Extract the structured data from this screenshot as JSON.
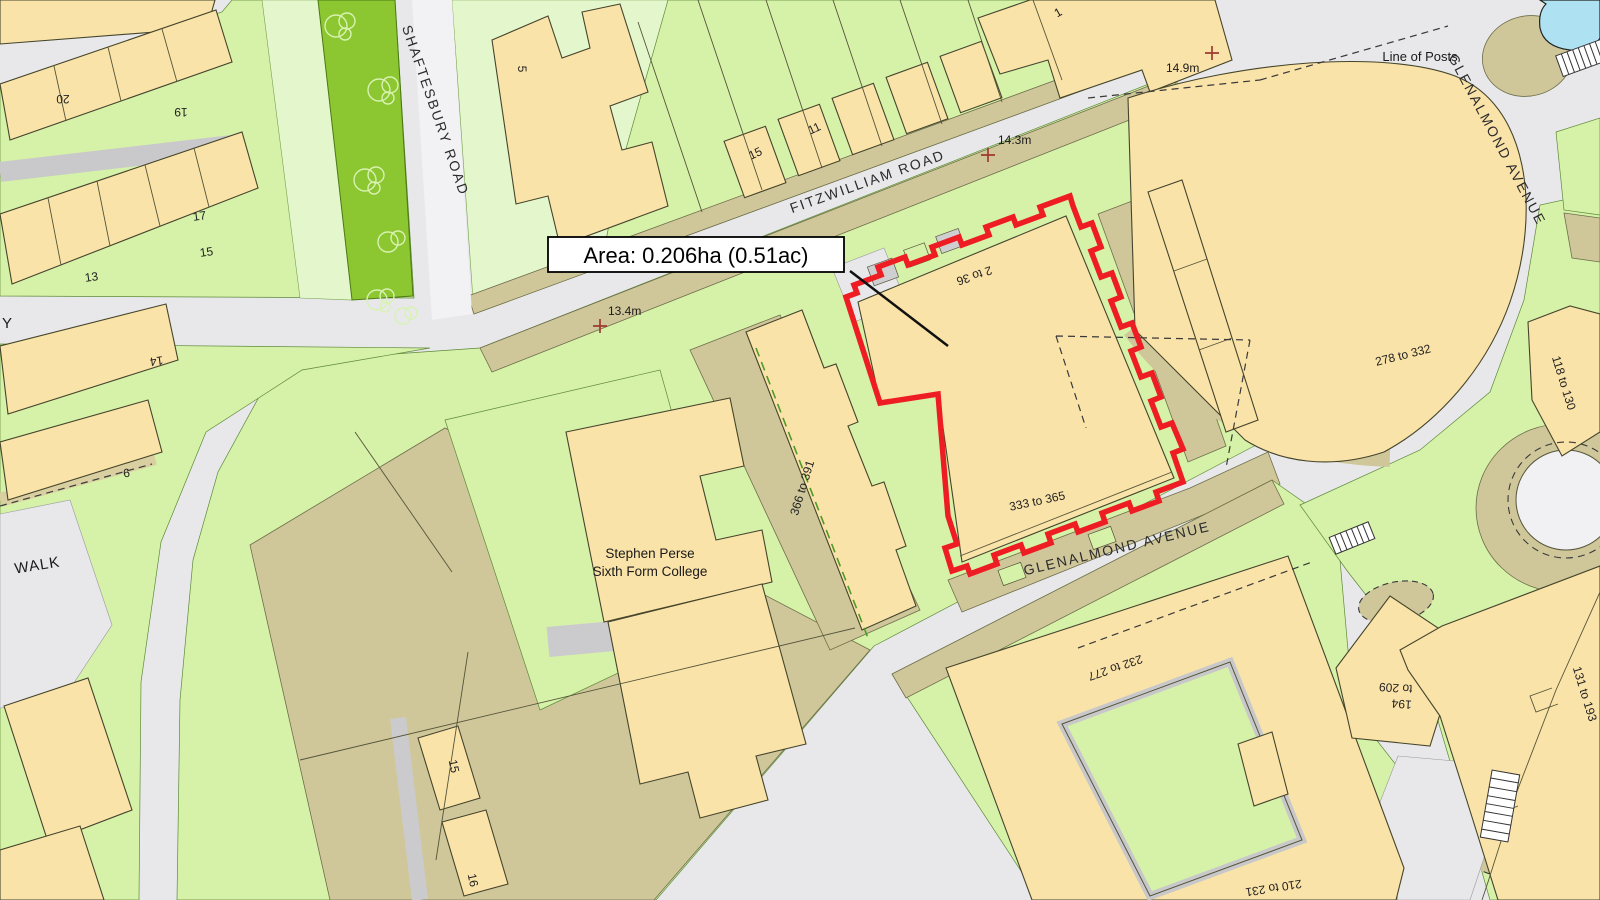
{
  "area_annotation": {
    "text": "Area: 0.206ha (0.51ac)"
  },
  "streets": {
    "shaftesbury": "SHAFTESBURY ROAD",
    "fitzwilliam": "FITZWILLIAM ROAD",
    "glenalmond_upper": "GLENALMOND AVENUE",
    "glenalmond_lower": "GLENALMOND AVENUE",
    "partial_y": "Y",
    "partial_walk": "WALK"
  },
  "annotations": {
    "line_of_posts": "Line of Posts"
  },
  "spot_heights": {
    "h1": "13.4m",
    "h2": "14.3m",
    "h3": "14.9m"
  },
  "places": {
    "college_line1": "Stephen Perse",
    "college_line2": "Sixth Form College"
  },
  "ranges": {
    "r2_36": "2 to 36",
    "r333_365": "333 to 365",
    "r366_391": "366 to 391",
    "r278_332": "278 to 332",
    "r118_130": "118 to 130",
    "r131_193": "131 to 193",
    "r232_277": "232 to 277",
    "r210_231": "210 to 231",
    "r194_line1": "194",
    "r194_line2": "to 209"
  },
  "house_numbers": {
    "n20": "20",
    "n19": "19",
    "n17": "17",
    "n15a": "15",
    "n13": "13",
    "n14": "14",
    "n6": "6",
    "n5": "5",
    "n15b": "15",
    "n11": "11",
    "n1": "1",
    "n15c": "15",
    "n16": "16"
  },
  "colors": {
    "building": "#FAE3A8",
    "garden_green": "#D6F1A8",
    "pale_green": "#E4F7CC",
    "verge_green": "#8CC630",
    "khaki": "#CFC79A",
    "road_grey": "#E8E8EA",
    "path_tan": "#D9CFA0",
    "water": "#AEE2F2",
    "site_boundary_red": "#EE1C23",
    "spot_cross": "#9E3A30"
  }
}
